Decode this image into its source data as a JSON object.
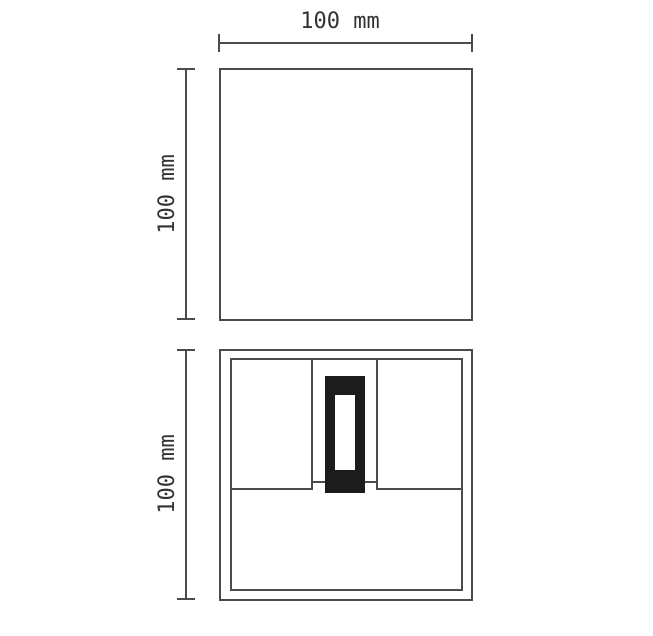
{
  "drawing": {
    "type": "technical-dimension-drawing",
    "top_view": {
      "width_dimension_label": "100 mm",
      "height_dimension_label": "100 mm"
    },
    "front_view": {
      "height_dimension_label": "100 mm"
    },
    "colors": {
      "line": "#4b4b4b",
      "module_fill": "#1c1c1c",
      "background": "#ffffff",
      "text": "#333333"
    }
  }
}
